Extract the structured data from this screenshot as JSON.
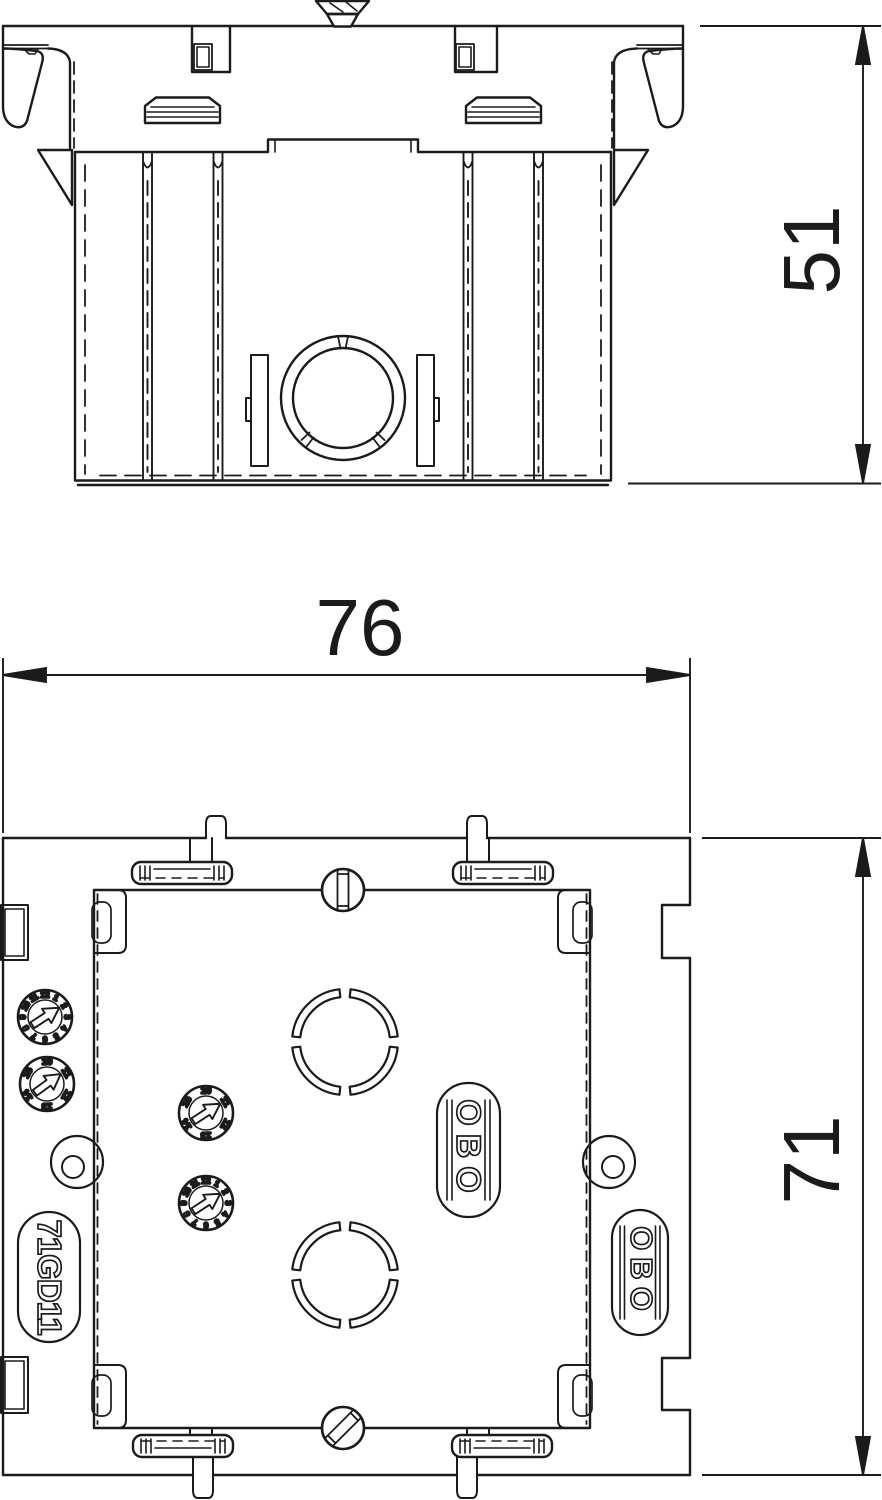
{
  "drawing": {
    "type": "technical-drawing",
    "views": [
      "side-elevation",
      "front-view"
    ],
    "dimensions": {
      "side_height_mm": "51",
      "front_width_mm": "76",
      "front_height_mm": "71"
    },
    "part_label": "71GD11",
    "brand_logo_1": "OBO",
    "brand_logo_2": "OBO",
    "colors": {
      "line": "#1b1b1b",
      "background": "#ffffff"
    },
    "front_view": {
      "dials": [
        {
          "cx": 45,
          "cy": 1017,
          "r": 27,
          "numbers": [
            "12",
            "1",
            "2",
            "3",
            "4",
            "5",
            "6",
            "7",
            "8",
            "9",
            "10",
            "11"
          ],
          "arrow_deg": -33
        },
        {
          "cx": 47,
          "cy": 1084,
          "r": 27,
          "numbers": [
            "10",
            "11",
            "12",
            "13",
            "14",
            "15"
          ],
          "arrow_deg": -36
        },
        {
          "cx": 206,
          "cy": 1113,
          "r": 27,
          "numbers": [
            "10",
            "11",
            "12",
            "13",
            "14",
            "15"
          ],
          "arrow_deg": -33
        },
        {
          "cx": 206,
          "cy": 1203,
          "r": 27,
          "numbers": [
            "12",
            "1",
            "2",
            "3",
            "4",
            "5",
            "6",
            "7",
            "8",
            "9",
            "10",
            "11"
          ],
          "arrow_deg": -33
        }
      ],
      "knockout_rings": [
        {
          "cx": 345,
          "cy": 1042,
          "R": 53,
          "r": 45,
          "gap_deg": 12
        },
        {
          "cx": 345,
          "cy": 1275,
          "R": 53,
          "r": 45,
          "gap_deg": 12
        }
      ]
    }
  }
}
